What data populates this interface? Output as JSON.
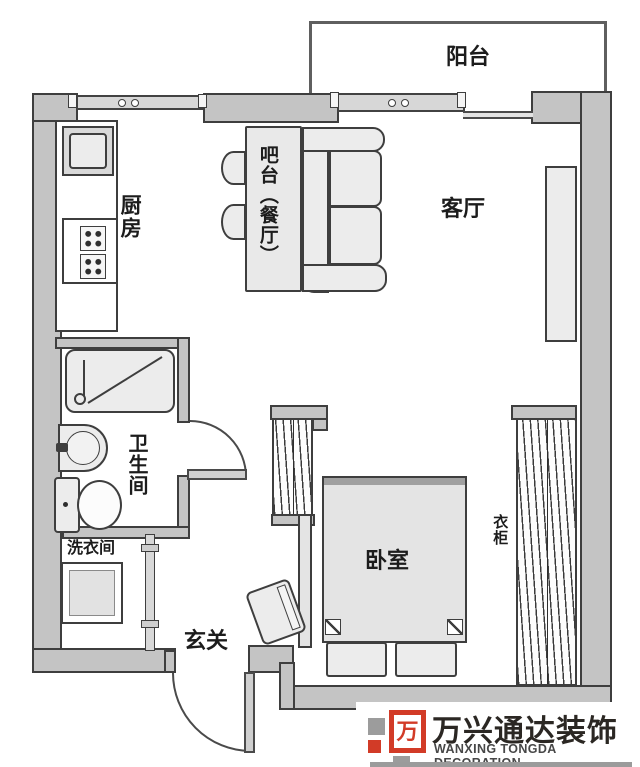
{
  "plan": {
    "rooms": {
      "balcony": "阳台",
      "kitchen": "厨房",
      "bar_dining": "吧台（餐厅）",
      "living_room": "客厅",
      "bathroom": "卫生间",
      "laundry": "洗衣间",
      "entrance": "玄关",
      "bedroom": "卧室",
      "wardrobe": "衣柜"
    },
    "fixtures": [
      "sink",
      "stove",
      "counter",
      "bar-table",
      "bar-stools",
      "sofa",
      "tv-cabinet",
      "shower",
      "washbasin",
      "toilet",
      "washing-machine",
      "bed",
      "pillows",
      "chair",
      "wardrobes",
      "entry-door",
      "bathroom-door",
      "windows"
    ]
  },
  "watermark": {
    "logo_glyph": "万",
    "company_cn": "万兴通达装饰",
    "company_en": "WANXING TONGDA DECORATION",
    "brand_red": "#d23b27",
    "brand_gray": "#9c9c9c"
  },
  "colors": {
    "wall_fill": "#c4c4c4",
    "wall_outline": "#3e3e3e",
    "furniture_fill": "#ececec"
  }
}
